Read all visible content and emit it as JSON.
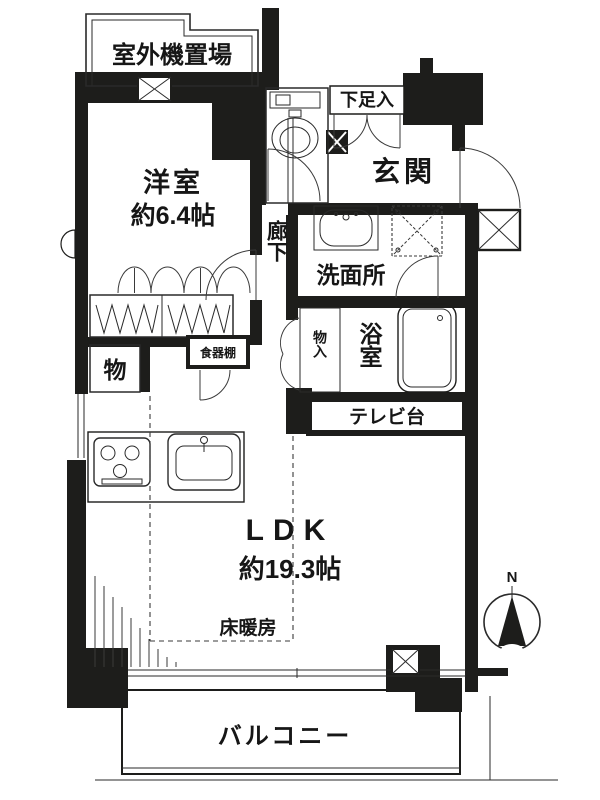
{
  "floor_plan": {
    "title": "apartment-floor-plan",
    "compass": {
      "north_label": "N"
    },
    "rooms": {
      "outdoor_unit": {
        "label": "室外機置場"
      },
      "western_room": {
        "label": "洋室",
        "size": "約6.4帖"
      },
      "shoe_box": {
        "label": "下足入"
      },
      "entrance": {
        "label": "玄関"
      },
      "corridor": {
        "label": "廊下"
      },
      "washroom": {
        "label": "洗面所"
      },
      "bath_closet": {
        "label": "物入"
      },
      "bathroom": {
        "label": "浴室"
      },
      "storage": {
        "label": "物"
      },
      "cupboard": {
        "label": "食器棚"
      },
      "tv_stand": {
        "label": "テレビ台"
      },
      "ldk": {
        "label": "LDK",
        "size": "約19.3帖"
      },
      "floor_heating": {
        "label": "床暖房"
      },
      "balcony": {
        "label": "バルコニー"
      }
    },
    "colors": {
      "wall": "#1d1d1b",
      "line": "#3a3a3a",
      "background": "#ffffff"
    }
  }
}
